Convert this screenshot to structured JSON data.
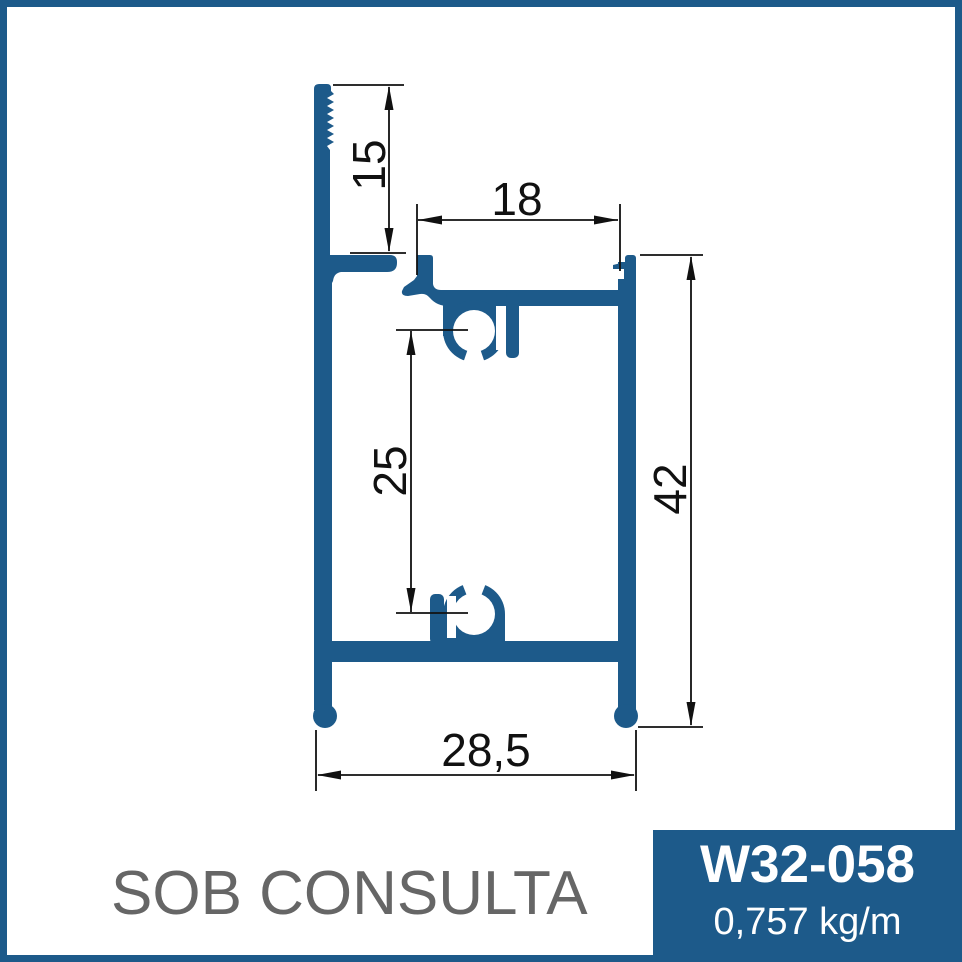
{
  "drawing": {
    "description": "aluminum-extrusion-profile-cross-section",
    "dims": {
      "d15": "15",
      "d18": "18",
      "d25": "25",
      "d42": "42",
      "d285": "28,5"
    },
    "units": "mm"
  },
  "footer": {
    "availability_label": "SOB CONSULTA",
    "product_code": "W32-058",
    "weight_per_meter": "0,757 kg/m"
  },
  "colors": {
    "brand_blue": "#1d5a8a",
    "line_black": "#111111",
    "muted_gray": "#666666",
    "background": "#ffffff"
  }
}
